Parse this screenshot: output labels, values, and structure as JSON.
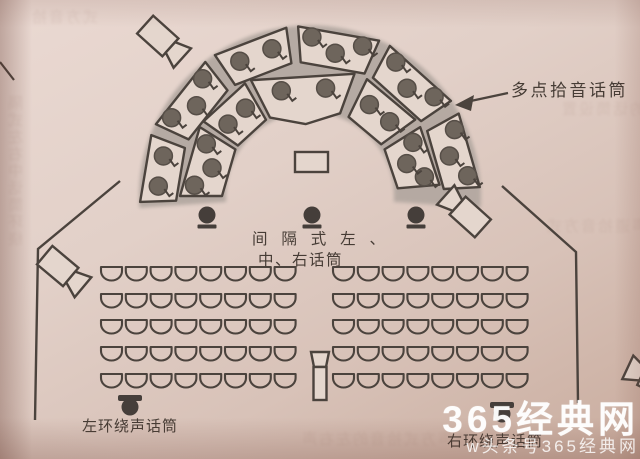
{
  "labels": {
    "multipoint": "多点拾音话筒",
    "spaced_line1": "间 隔 式 左 、",
    "spaced_line2": "中、右话筒",
    "left_surround": "左环绕声话筒",
    "right_surround": "右环绕声话筒"
  },
  "watermark": {
    "line1": "365经典网",
    "line2": "w头条号365经典网"
  },
  "decoration": {
    "bleed": [
      "隔式左右中话筒环绕",
      "的话筒设置",
      "声道拾音方式",
      "体声方式拾音的左右声",
      "式方音拾"
    ]
  },
  "diagram": {
    "colors": {
      "stroke": "#4b433d",
      "paper": "#e4d6cd",
      "band": "#b2a7a0",
      "dot": "#6e655c",
      "dot_edge": "#564e47",
      "dark_mic": "#453e3a"
    },
    "center": [
      310,
      196
    ],
    "band": {
      "inner_r": 84,
      "outer_r": 171
    },
    "inner_ring": {
      "r1": 88,
      "r2": 130,
      "mid": 109,
      "sections": [
        {
          "a1": 148,
          "a2": 180,
          "dots": 3
        },
        {
          "a1": 120,
          "a2": 145,
          "dots": 2
        },
        {
          "a1": 70,
          "a2": 117,
          "dots": 2,
          "apex": true
        },
        {
          "a1": 36,
          "a2": 64,
          "dots": 2
        },
        {
          "a1": 5,
          "a2": 32,
          "dots": 3
        }
      ]
    },
    "outer_ring": {
      "r1": 134,
      "r2": 170,
      "mid": 152,
      "sections": [
        {
          "a1": 159,
          "a2": 182,
          "dots": 2
        },
        {
          "a1": 128,
          "a2": 155,
          "dots": 3
        },
        {
          "a1": 98,
          "a2": 124,
          "dots": 2
        },
        {
          "a1": 66,
          "a2": 94,
          "dots": 3
        },
        {
          "a1": 34,
          "a2": 62,
          "dots": 3
        },
        {
          "a1": 3,
          "a2": 29,
          "dots": 3
        }
      ]
    },
    "podium": {
      "x": 295,
      "y": 152,
      "w": 33,
      "h": 20
    },
    "front_mics": {
      "xs": [
        207,
        312,
        416
      ],
      "y": 215
    },
    "surround_mics": [
      {
        "x": 130,
        "y": 407
      },
      {
        "x": 502,
        "y": 414
      }
    ],
    "aisle_mic": {
      "top": [
        311,
        352,
        329,
        352,
        326,
        367,
        314,
        367
      ],
      "body": [
        313.5,
        367,
        13,
        33
      ]
    },
    "cameras": [
      {
        "x": 160,
        "y": 38,
        "rot": 42
      },
      {
        "x": 468,
        "y": 215,
        "rot": -138
      },
      {
        "x": 60,
        "y": 268,
        "rot": 40
      },
      {
        "x": 655,
        "y": 380,
        "rot": -155
      }
    ],
    "walls": [
      [
        [
          120,
          181
        ],
        [
          38,
          249
        ],
        [
          35,
          420
        ]
      ],
      [
        [
          502,
          186
        ],
        [
          576,
          252
        ],
        [
          578,
          403
        ]
      ]
    ],
    "stray_line": [
      [
        0,
        62
      ],
      [
        14,
        80
      ]
    ],
    "arrow": {
      "x1": 508,
      "y1": 93,
      "x2": 466,
      "y2": 102,
      "head": [
        [
          455,
          105
        ],
        [
          474,
          95
        ],
        [
          471,
          111
        ]
      ]
    },
    "seats": {
      "rows_y": [
        267,
        294,
        320,
        347,
        374
      ],
      "blocks_x0": [
        101,
        333
      ],
      "cols": 8,
      "pitch": 24.8,
      "half_w": 10.5
    }
  }
}
